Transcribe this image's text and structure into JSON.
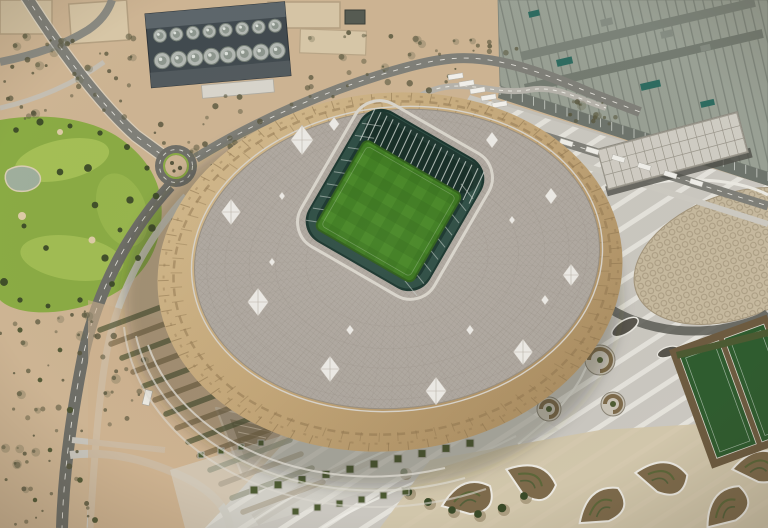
{
  "scene": {
    "description": "Aerial photograph of a golden diamond-clad football stadium with an open roof revealing a green pitch, surrounded by desert terrain, a golf course, access roads, a roundabout, large flat-roofed buildings and ornamental concrete plazas",
    "regions": {
      "stadium": "golden diamond-patterned stadium with lattice roof and open bowl",
      "pitch": "green football pitch with mowing pattern",
      "golf_course": "green golf fairways with pond on the left",
      "desert": "sandy terrain with scattered shrubs",
      "roundabout": "road roundabout upper left",
      "industrial_building": "dark rooftop building with rows of circular tanks",
      "large_roof_building": "large panel-roofed complex upper right",
      "plaza": "striped concrete plaza with curved paths, spiral planters and garden beds",
      "honeycomb_plaza": "oval honeycomb-paved plaza on the right",
      "sports_fields": "small green sports fields far right"
    }
  },
  "palette": {
    "sand": "#cdb493",
    "sand_light": "#dbc8a7",
    "shrub": "#57553c",
    "golf_green": "#8aab44",
    "golf_light": "#a6c158",
    "tree": "#3c4a28",
    "pond": "#9fae9c",
    "road": "#7f7f78",
    "road_dark": "#5b5b54",
    "road_line": "#eceae3",
    "concrete": "#cac7c0",
    "concrete_light": "#dad7cf",
    "stripe": "#e9e7e0",
    "facade_gold": "#c3a678",
    "facade_gold_dark": "#8d744e",
    "roof": "#afa8a0",
    "roof_line": "#948d83",
    "diamond_white": "#f0eeea",
    "bowl": "#17332c",
    "bowl_mid": "#2f5046",
    "truss": "#ccd4cf",
    "pitch": "#3c7a1e",
    "pitch_light": "#4a8c27",
    "building_dark": "#414a4f",
    "tank": "#b3b8b3",
    "bigroof": "#99a094",
    "teal_accent": "#2e6b60",
    "honeycomb": "#c6b99e",
    "planter_green": "#4e5c33",
    "planter_brown": "#7d6a4b",
    "field_green": "#2f5c2f",
    "dirt": "#6d5b40"
  }
}
